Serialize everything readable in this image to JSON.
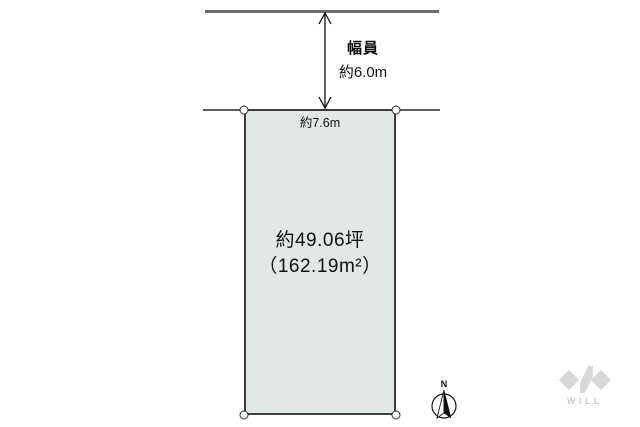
{
  "colors": {
    "plot_fill": "#e2e8e4",
    "road_line": "#6b6b6b",
    "logo_gray": "#d7d7d7",
    "logo_text": "#cbcbcb"
  },
  "road": {
    "width_title": "幅員",
    "width_value": "約6.0m"
  },
  "plot": {
    "frontage": "約7.6m",
    "area_tsubo": "約49.06坪",
    "area_m2": "（162.19m²）"
  },
  "compass": {
    "north": "N"
  },
  "logo": {
    "text": "WILL"
  }
}
